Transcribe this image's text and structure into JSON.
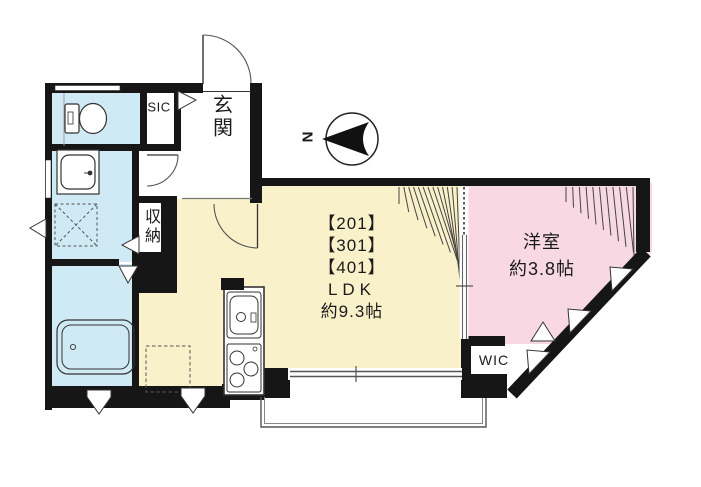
{
  "plan": {
    "compass_label": "N",
    "rooms": {
      "sic": "SIC",
      "entrance": "玄関",
      "storage": "収納",
      "ldk_units": [
        "【201】",
        "【301】",
        "【401】"
      ],
      "ldk_name": "LDK",
      "ldk_size": "約9.3帖",
      "bedroom_name": "洋室",
      "bedroom_size": "約3.8帖",
      "wic": "WIC"
    },
    "colors": {
      "water": "#cfeaf4",
      "ldk": "#f8f1c9",
      "bedroom": "#f8d9e3",
      "wall": "#161616",
      "line": "#444444"
    }
  }
}
